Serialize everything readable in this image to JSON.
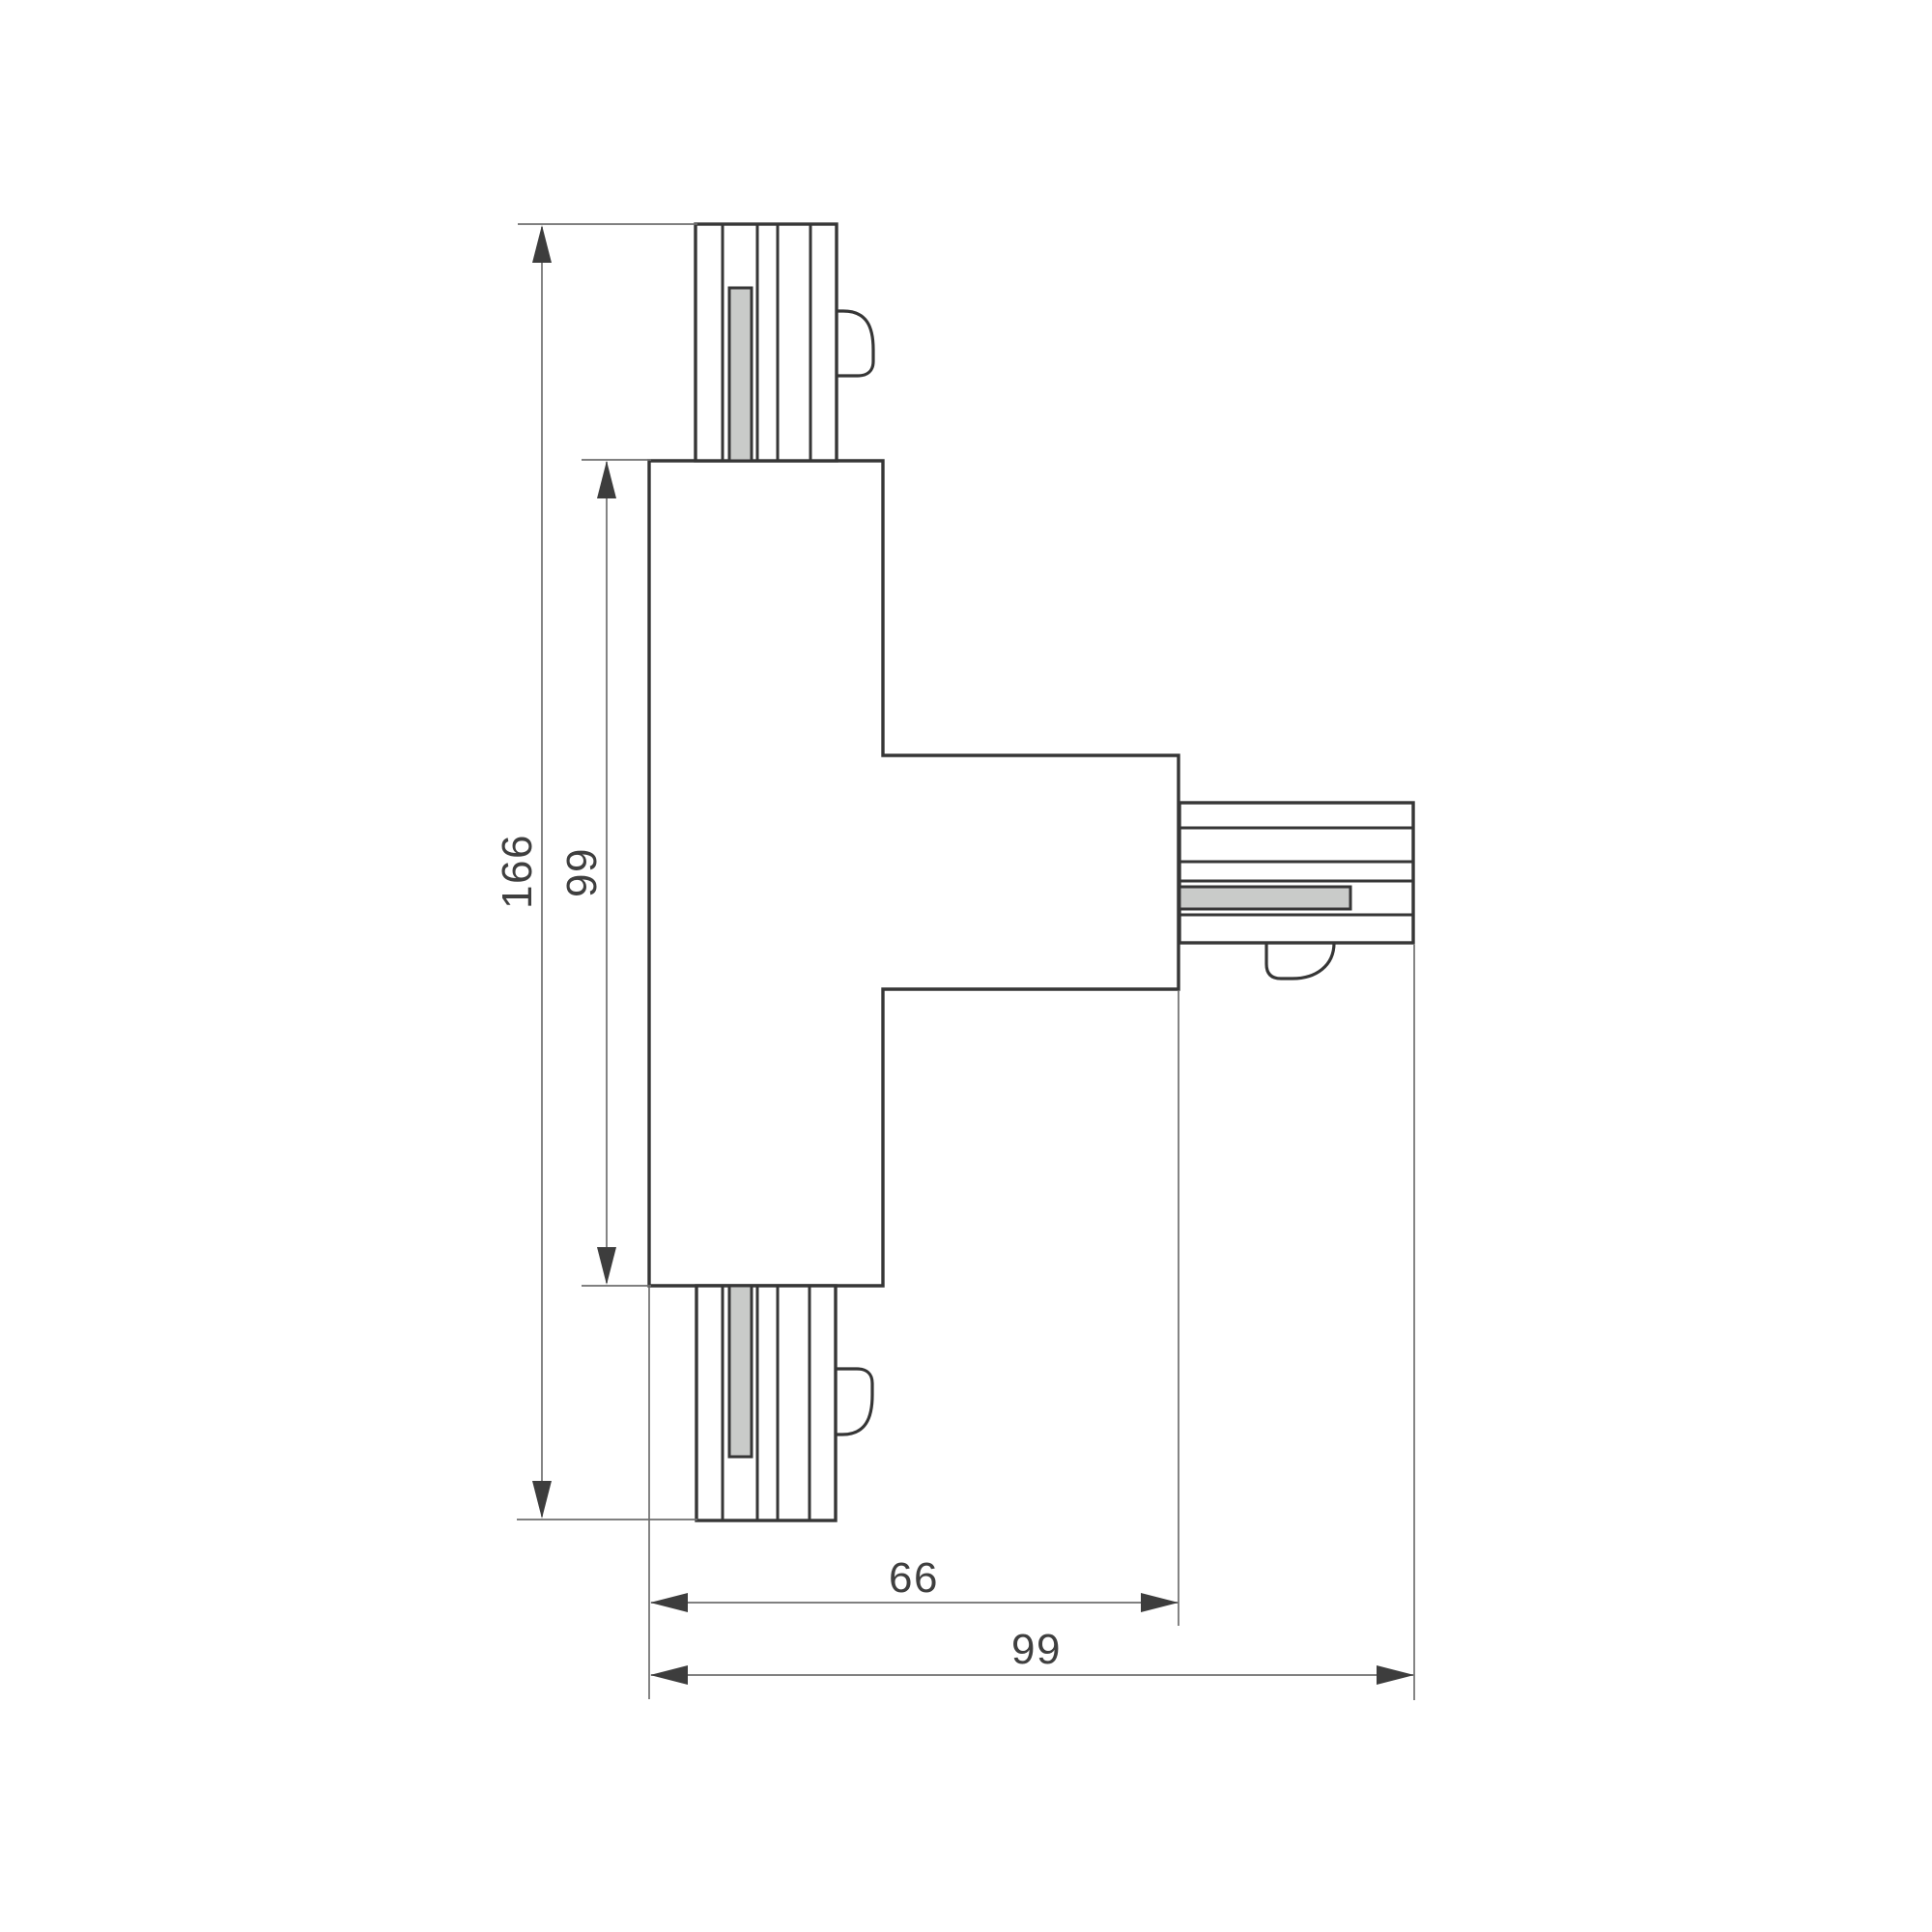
{
  "colors": {
    "background": "#ffffff",
    "outline": "#363636",
    "thin_line": "#6e6e6e",
    "arrow": "#3d3d3d",
    "contact_fill": "#c9cbc9",
    "label_text": "#3f3f3f"
  },
  "dimensions": {
    "overall_height": "166",
    "body_height": "99",
    "body_width": "66",
    "overall_width": "99"
  }
}
